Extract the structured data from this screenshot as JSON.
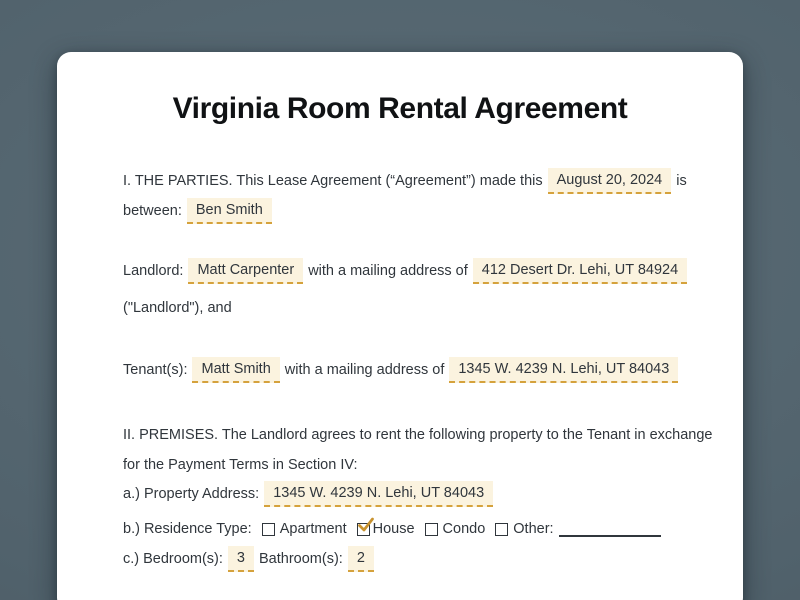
{
  "document": {
    "title": "Virginia Room Rental Agreement",
    "parties": {
      "intro": "I. THE PARTIES. This Lease Agreement (“Agreement”) made this",
      "date": "August 20, 2024",
      "after_date": "is",
      "between_label": "between:",
      "party_name": "Ben Smith"
    },
    "landlord": {
      "label": "Landlord:",
      "name": "Matt Carpenter",
      "address_text": "with a mailing address of",
      "address": "412 Desert Dr. Lehi, UT 84924",
      "closing": "(\"Landlord\"), and"
    },
    "tenant": {
      "label": "Tenant(s):",
      "name": "Matt Smith",
      "address_text": "with a mailing address of",
      "address": "1345 W. 4239 N. Lehi, UT 84043"
    },
    "premises": {
      "intro_line1": "II. PREMISES. The Landlord agrees to rent the following property to the Tenant in exchange",
      "intro_line2": "for the Payment Terms in Section IV:",
      "address_label": "a.) Property Address:",
      "address": "1345 W. 4239 N. Lehi, UT 84043",
      "residence_label": "b.) Residence Type:",
      "residence_options": [
        {
          "label": "Apartment",
          "checked": false
        },
        {
          "label": "House",
          "checked": true
        },
        {
          "label": "Condo",
          "checked": false
        },
        {
          "label": "Other:",
          "checked": false
        }
      ],
      "bedrooms_label": "c.) Bedroom(s):",
      "bedrooms_value": "3",
      "bathrooms_label": "Bathroom(s):",
      "bathrooms_value": "2"
    }
  },
  "colors": {
    "page_background": "#51626c",
    "card_background": "#ffffff",
    "body_text": "#30363c",
    "title_text": "#101214",
    "field_highlight": "#fbf3df",
    "field_underline": "#d5a23c",
    "checkmark": "#c8922e"
  }
}
